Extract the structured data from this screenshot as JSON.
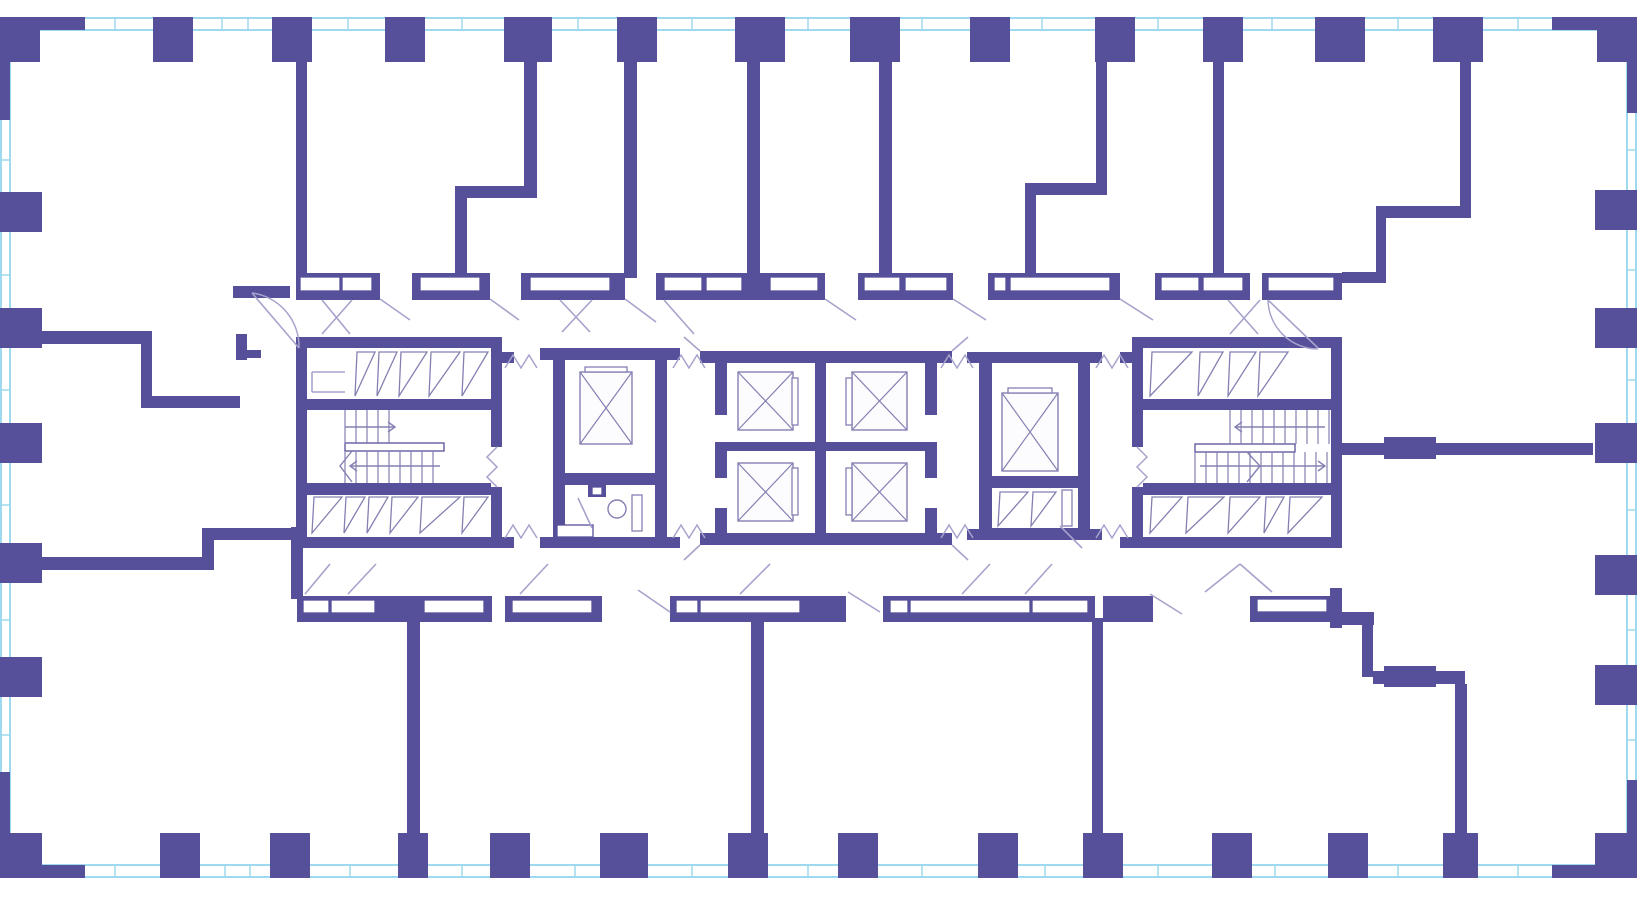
{
  "title": "residential-tower-typical-floor-plan",
  "canvas": {
    "w": 1637,
    "h": 900
  },
  "colors": {
    "wall": "#56509B",
    "glazing": "#9ED9F0",
    "detail": "#8480B2",
    "swing": "#A6A3CC",
    "fixture": "#8480B2",
    "paper": "#FFFFFF",
    "box_fill": "#FFFFFF",
    "car_fill": "#FCFCFE"
  },
  "plan": {
    "bands": [
      {
        "o": "h",
        "e1": 18,
        "e2": 30,
        "from": 0,
        "to": 1637,
        "ticks": [
          70,
          115,
          222,
          248,
          348,
          462,
          578,
          692,
          808,
          922,
          1042,
          1158,
          1272,
          1398,
          1518
        ]
      },
      {
        "o": "h",
        "e1": 865,
        "e2": 877,
        "from": 0,
        "to": 1637,
        "ticks": [
          70,
          115,
          225,
          250,
          350,
          462,
          575,
          692,
          808,
          922,
          1045,
          1158,
          1275,
          1398,
          1518
        ]
      },
      {
        "o": "v",
        "e1": 1,
        "e2": 10,
        "from": 18,
        "to": 877,
        "ticks": [
          160,
          275,
          390,
          505,
          620,
          735
        ]
      },
      {
        "o": "v",
        "e1": 1627,
        "e2": 1636,
        "from": 18,
        "to": 877,
        "ticks": [
          150,
          270,
          380,
          510,
          630,
          740
        ]
      }
    ],
    "walls": [
      [
        0,
        17,
        85,
        13
      ],
      [
        0,
        17,
        40,
        45
      ],
      [
        0,
        30,
        10,
        90
      ],
      [
        153,
        17,
        40,
        45
      ],
      [
        272,
        17,
        40,
        45
      ],
      [
        385,
        17,
        40,
        45
      ],
      [
        504,
        17,
        48,
        45
      ],
      [
        617,
        17,
        40,
        45
      ],
      [
        735,
        17,
        50,
        45
      ],
      [
        850,
        17,
        50,
        45
      ],
      [
        970,
        17,
        40,
        45
      ],
      [
        1095,
        17,
        40,
        45
      ],
      [
        1203,
        17,
        40,
        45
      ],
      [
        1315,
        17,
        50,
        45
      ],
      [
        1433,
        17,
        50,
        45
      ],
      [
        1552,
        17,
        85,
        13
      ],
      [
        1597,
        17,
        40,
        45
      ],
      [
        1627,
        30,
        10,
        83
      ],
      [
        0,
        865,
        85,
        13
      ],
      [
        0,
        833,
        42,
        45
      ],
      [
        0,
        772,
        10,
        93
      ],
      [
        160,
        833,
        40,
        45
      ],
      [
        270,
        833,
        40,
        45
      ],
      [
        398,
        833,
        30,
        45
      ],
      [
        490,
        833,
        40,
        45
      ],
      [
        600,
        833,
        48,
        45
      ],
      [
        728,
        833,
        40,
        45
      ],
      [
        838,
        833,
        40,
        45
      ],
      [
        978,
        833,
        40,
        45
      ],
      [
        1083,
        833,
        40,
        45
      ],
      [
        1212,
        833,
        40,
        45
      ],
      [
        1328,
        833,
        40,
        45
      ],
      [
        1443,
        833,
        35,
        45
      ],
      [
        1552,
        865,
        85,
        13
      ],
      [
        1595,
        833,
        42,
        45
      ],
      [
        1627,
        780,
        10,
        85
      ],
      [
        0,
        192,
        42,
        40
      ],
      [
        0,
        308,
        42,
        40
      ],
      [
        0,
        423,
        42,
        40
      ],
      [
        0,
        543,
        42,
        40
      ],
      [
        0,
        657,
        42,
        40
      ],
      [
        1595,
        190,
        42,
        40
      ],
      [
        1595,
        308,
        42,
        40
      ],
      [
        1595,
        423,
        42,
        40
      ],
      [
        1595,
        555,
        42,
        40
      ],
      [
        1595,
        665,
        42,
        40
      ],
      [
        296,
        62,
        11,
        216
      ],
      [
        524,
        62,
        13,
        126
      ],
      [
        455,
        186,
        82,
        12
      ],
      [
        455,
        198,
        12,
        80
      ],
      [
        624,
        62,
        13,
        216
      ],
      [
        747,
        62,
        13,
        216
      ],
      [
        879,
        62,
        13,
        216
      ],
      [
        1096,
        62,
        11,
        123
      ],
      [
        1025,
        183,
        82,
        12
      ],
      [
        1025,
        195,
        11,
        83
      ],
      [
        1213,
        62,
        11,
        216
      ],
      [
        1460,
        62,
        11,
        148
      ],
      [
        1376,
        206,
        95,
        12
      ],
      [
        1376,
        218,
        10,
        60
      ],
      [
        1342,
        272,
        44,
        11
      ],
      [
        296,
        273,
        84,
        27
      ],
      [
        412,
        273,
        78,
        27
      ],
      [
        521,
        273,
        104,
        27
      ],
      [
        656,
        273,
        169,
        27
      ],
      [
        858,
        273,
        95,
        27
      ],
      [
        988,
        273,
        132,
        27
      ],
      [
        1155,
        273,
        95,
        27
      ],
      [
        1262,
        273,
        80,
        27
      ],
      [
        233,
        286,
        57,
        12
      ],
      [
        8,
        331,
        144,
        13
      ],
      [
        141,
        344,
        11,
        64
      ],
      [
        141,
        396,
        99,
        12
      ],
      [
        236,
        334,
        11,
        26
      ],
      [
        247,
        350,
        14,
        8
      ],
      [
        28,
        557,
        184,
        13
      ],
      [
        202,
        536,
        12,
        34
      ],
      [
        202,
        528,
        96,
        12
      ],
      [
        291,
        527,
        12,
        72
      ],
      [
        297,
        596,
        195,
        26
      ],
      [
        505,
        596,
        97,
        26
      ],
      [
        670,
        596,
        176,
        26
      ],
      [
        883,
        596,
        212,
        26
      ],
      [
        1103,
        596,
        50,
        26
      ],
      [
        1250,
        596,
        92,
        26
      ],
      [
        407,
        618,
        13,
        215
      ],
      [
        751,
        618,
        13,
        215
      ],
      [
        1092,
        618,
        11,
        215
      ],
      [
        1330,
        588,
        12,
        40
      ],
      [
        1342,
        612,
        32,
        13
      ],
      [
        1362,
        625,
        11,
        52
      ],
      [
        1373,
        671,
        92,
        13
      ],
      [
        1384,
        666,
        52,
        21
      ],
      [
        1455,
        684,
        12,
        149
      ],
      [
        1342,
        443,
        251,
        12
      ],
      [
        1384,
        437,
        52,
        22
      ],
      [
        296,
        337,
        206,
        11
      ],
      [
        296,
        337,
        11,
        211
      ],
      [
        491,
        337,
        11,
        110
      ],
      [
        491,
        487,
        11,
        61
      ],
      [
        296,
        537,
        206,
        11
      ],
      [
        307,
        399,
        184,
        11
      ],
      [
        307,
        483,
        184,
        12
      ],
      [
        553,
        348,
        114,
        12
      ],
      [
        553,
        348,
        12,
        200
      ],
      [
        655,
        348,
        12,
        200
      ],
      [
        553,
        473,
        114,
        12
      ],
      [
        588,
        485,
        18,
        12
      ],
      [
        553,
        537,
        114,
        11
      ],
      [
        540,
        348,
        13,
        12
      ],
      [
        667,
        348,
        13,
        12
      ],
      [
        540,
        537,
        13,
        11
      ],
      [
        667,
        537,
        13,
        11
      ],
      [
        502,
        352,
        12,
        11
      ],
      [
        502,
        537,
        12,
        11
      ],
      [
        715,
        351,
        222,
        12
      ],
      [
        715,
        533,
        222,
        12
      ],
      [
        700,
        351,
        15,
        12
      ],
      [
        937,
        351,
        15,
        12
      ],
      [
        700,
        533,
        15,
        12
      ],
      [
        937,
        533,
        15,
        12
      ],
      [
        715,
        351,
        12,
        64
      ],
      [
        715,
        442,
        12,
        36
      ],
      [
        715,
        508,
        12,
        37
      ],
      [
        925,
        351,
        12,
        64
      ],
      [
        925,
        442,
        12,
        36
      ],
      [
        925,
        508,
        12,
        37
      ],
      [
        727,
        442,
        198,
        9
      ],
      [
        815,
        363,
        11,
        170
      ],
      [
        979,
        352,
        111,
        11
      ],
      [
        979,
        352,
        13,
        188
      ],
      [
        1078,
        352,
        12,
        188
      ],
      [
        979,
        476,
        111,
        12
      ],
      [
        979,
        528,
        111,
        12
      ],
      [
        967,
        352,
        12,
        11
      ],
      [
        1090,
        352,
        12,
        11
      ],
      [
        967,
        529,
        12,
        11
      ],
      [
        1090,
        529,
        12,
        11
      ],
      [
        1132,
        337,
        210,
        11
      ],
      [
        1331,
        337,
        11,
        211
      ],
      [
        1132,
        337,
        11,
        110
      ],
      [
        1132,
        487,
        11,
        61
      ],
      [
        1132,
        537,
        210,
        11
      ],
      [
        1143,
        399,
        188,
        11
      ],
      [
        1143,
        483,
        188,
        12
      ],
      [
        1120,
        352,
        12,
        11
      ],
      [
        1120,
        537,
        12,
        11
      ]
    ],
    "boxes": [
      [
        300,
        277,
        40,
        14
      ],
      [
        342,
        277,
        30,
        14
      ],
      [
        420,
        277,
        60,
        14
      ],
      [
        530,
        277,
        80,
        14
      ],
      [
        664,
        277,
        38,
        14
      ],
      [
        706,
        277,
        36,
        14
      ],
      [
        770,
        277,
        48,
        14
      ],
      [
        864,
        277,
        36,
        14
      ],
      [
        905,
        277,
        42,
        14
      ],
      [
        994,
        277,
        12,
        14
      ],
      [
        1010,
        277,
        100,
        14
      ],
      [
        1161,
        277,
        38,
        14
      ],
      [
        1203,
        277,
        40,
        14
      ],
      [
        1268,
        277,
        66,
        14
      ],
      [
        303,
        600,
        26,
        13
      ],
      [
        331,
        600,
        44,
        13
      ],
      [
        424,
        600,
        60,
        13
      ],
      [
        512,
        600,
        80,
        13
      ],
      [
        676,
        600,
        22,
        13
      ],
      [
        700,
        600,
        100,
        13
      ],
      [
        890,
        600,
        18,
        13
      ],
      [
        910,
        600,
        120,
        13
      ],
      [
        1032,
        600,
        56,
        13
      ],
      [
        1257,
        599,
        70,
        13
      ],
      [
        345,
        443,
        99,
        8
      ],
      [
        1195,
        444,
        100,
        8
      ],
      [
        557,
        525,
        36,
        12
      ],
      [
        592,
        487,
        10,
        8
      ]
    ],
    "cars": [
      [
        580,
        372,
        52,
        72
      ],
      [
        1002,
        393,
        56,
        78
      ],
      [
        738,
        372,
        55,
        58
      ],
      [
        852,
        372,
        55,
        58
      ],
      [
        738,
        463,
        55,
        58
      ],
      [
        852,
        463,
        55,
        58
      ]
    ],
    "doorbars": [
      [
        585,
        367,
        42,
        5
      ],
      [
        1008,
        388,
        44,
        5
      ],
      [
        792,
        378,
        6,
        47
      ],
      [
        846,
        378,
        6,
        47
      ],
      [
        792,
        468,
        6,
        47
      ],
      [
        846,
        468,
        6,
        47
      ],
      [
        632,
        495,
        10,
        36
      ],
      [
        1062,
        490,
        10,
        36
      ]
    ],
    "vents": [
      [
        355,
        352,
        20,
        44
      ],
      [
        377,
        352,
        20,
        44
      ],
      [
        399,
        352,
        28,
        44
      ],
      [
        429,
        352,
        31,
        44
      ],
      [
        462,
        352,
        26,
        44
      ],
      [
        312,
        497,
        30,
        36
      ],
      [
        344,
        497,
        21,
        36
      ],
      [
        367,
        497,
        21,
        36
      ],
      [
        390,
        497,
        28,
        36
      ],
      [
        420,
        497,
        40,
        36
      ],
      [
        462,
        497,
        26,
        36
      ],
      [
        1150,
        352,
        42,
        44
      ],
      [
        1198,
        352,
        25,
        44
      ],
      [
        1228,
        352,
        28,
        44
      ],
      [
        1258,
        352,
        30,
        44
      ],
      [
        1150,
        497,
        32,
        36
      ],
      [
        1186,
        497,
        38,
        36
      ],
      [
        1228,
        497,
        32,
        36
      ],
      [
        1264,
        497,
        20,
        36
      ],
      [
        1288,
        497,
        34,
        36
      ],
      [
        998,
        492,
        30,
        34
      ],
      [
        1031,
        492,
        25,
        34
      ]
    ],
    "tread_groups": [
      {
        "x1": 345,
        "x2": 399,
        "y": 410,
        "h": 34,
        "step": 11
      },
      {
        "x1": 345,
        "x2": 443,
        "y": 451,
        "h": 32,
        "step": 11
      },
      {
        "x1": 1230,
        "x2": 1330,
        "y": 410,
        "h": 34,
        "step": 11
      },
      {
        "x1": 1195,
        "x2": 1330,
        "y": 452,
        "h": 31,
        "step": 11
      }
    ],
    "arrows": [
      "345,427 395,427",
      "388,422 395,427 388,432",
      "440,466 350,466",
      "357,461 350,466 357,471",
      "1325,427 1235,427",
      "1242,422 1235,427 1242,432",
      "1200,466 1325,466",
      "1318,461 1325,466 1318,471",
      "352,451 340,466 352,482",
      "1247,452 1260,466 1247,482"
    ],
    "zigzags": [
      "505,368 513,355 521,368 529,355 537,368",
      "505,538 513,525 521,538 529,525 537,538",
      "673,368 681,355 689,368 697,355 705,368",
      "673,538 681,525 689,538 697,525 705,538",
      "941,368 949,355 957,368 965,355 973,368",
      "941,538 949,525 957,538 965,525 973,538",
      "1096,368 1104,355 1112,368 1120,355 1128,368",
      "1096,538 1104,525 1112,538 1120,525 1128,538",
      "497,447 487,457 497,467 487,477 497,487",
      "1137,447 1147,457 1137,467 1147,477 1137,487"
    ],
    "swing_lines": [
      [
        380,
        299,
        410,
        320
      ],
      [
        490,
        299,
        519,
        320
      ],
      [
        825,
        299,
        856,
        320
      ],
      [
        953,
        299,
        986,
        320
      ],
      [
        1120,
        299,
        1153,
        320
      ],
      [
        322,
        300,
        350,
        334
      ],
      [
        352,
        300,
        322,
        334
      ],
      [
        560,
        300,
        590,
        332
      ],
      [
        592,
        300,
        562,
        332
      ],
      [
        625,
        299,
        656,
        322
      ],
      [
        664,
        300,
        694,
        334
      ],
      [
        1228,
        300,
        1258,
        334
      ],
      [
        1260,
        300,
        1230,
        334
      ],
      [
        252,
        293,
        299,
        348
      ],
      [
        1268,
        300,
        1318,
        348
      ],
      [
        305,
        594,
        330,
        564
      ],
      [
        348,
        594,
        376,
        564
      ],
      [
        520,
        594,
        548,
        564
      ],
      [
        638,
        590,
        670,
        612
      ],
      [
        740,
        594,
        770,
        564
      ],
      [
        848,
        592,
        880,
        612
      ],
      [
        962,
        594,
        990,
        564
      ],
      [
        1025,
        594,
        1052,
        564
      ],
      [
        1150,
        594,
        1182,
        614
      ],
      [
        1205,
        592,
        1240,
        564
      ],
      [
        1240,
        564,
        1272,
        592
      ],
      [
        700,
        351,
        684,
        337
      ],
      [
        952,
        351,
        968,
        337
      ],
      [
        700,
        545,
        684,
        560
      ],
      [
        952,
        545,
        968,
        560
      ],
      [
        578,
        498,
        592,
        528
      ],
      [
        1060,
        526,
        1082,
        548
      ],
      [
        312,
        372,
        345,
        372
      ],
      [
        312,
        392,
        345,
        392
      ],
      [
        312,
        372,
        312,
        392
      ]
    ],
    "arcs": [
      "M252,293 A54,54 0 0 1 299,348",
      "M1268,300 A50,50 0 0 0 1318,349"
    ],
    "circles": [
      [
        617,
        509,
        9
      ]
    ]
  }
}
